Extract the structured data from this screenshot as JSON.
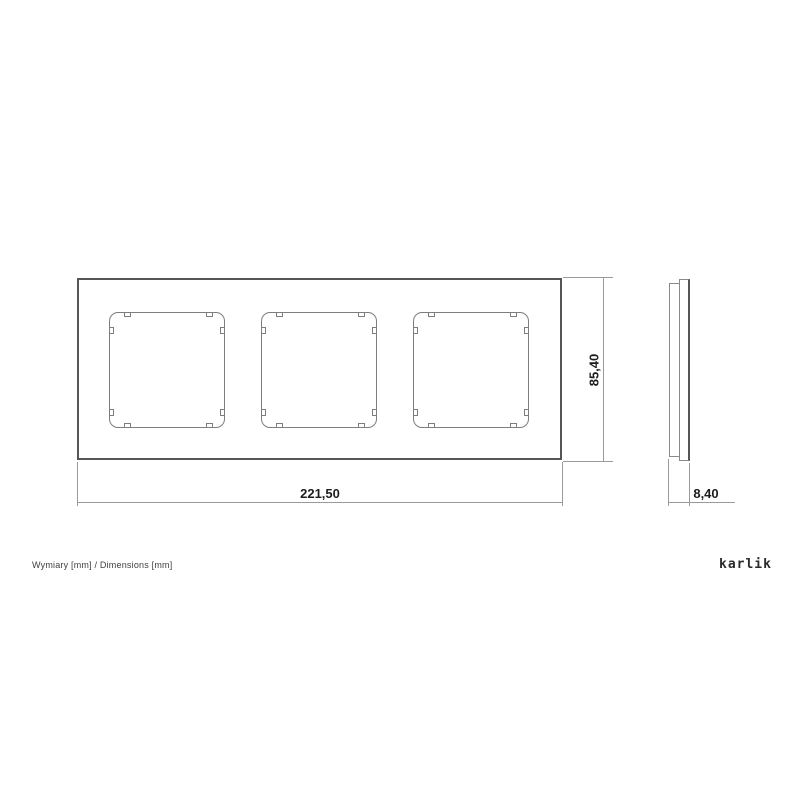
{
  "page": {
    "caption": "Wymiary [mm] / Dimensions [mm]",
    "brand_logo": "karlik"
  },
  "drawing": {
    "type": "technical-dimension-drawing",
    "subject": "triple wall-switch frame, front view and side profile view",
    "units": "mm",
    "dimensions": {
      "width": "221,50",
      "height": "85,40",
      "depth": "8,40"
    },
    "front_view": {
      "openings_count": 3,
      "mount_tabs_per_opening": 8
    }
  }
}
